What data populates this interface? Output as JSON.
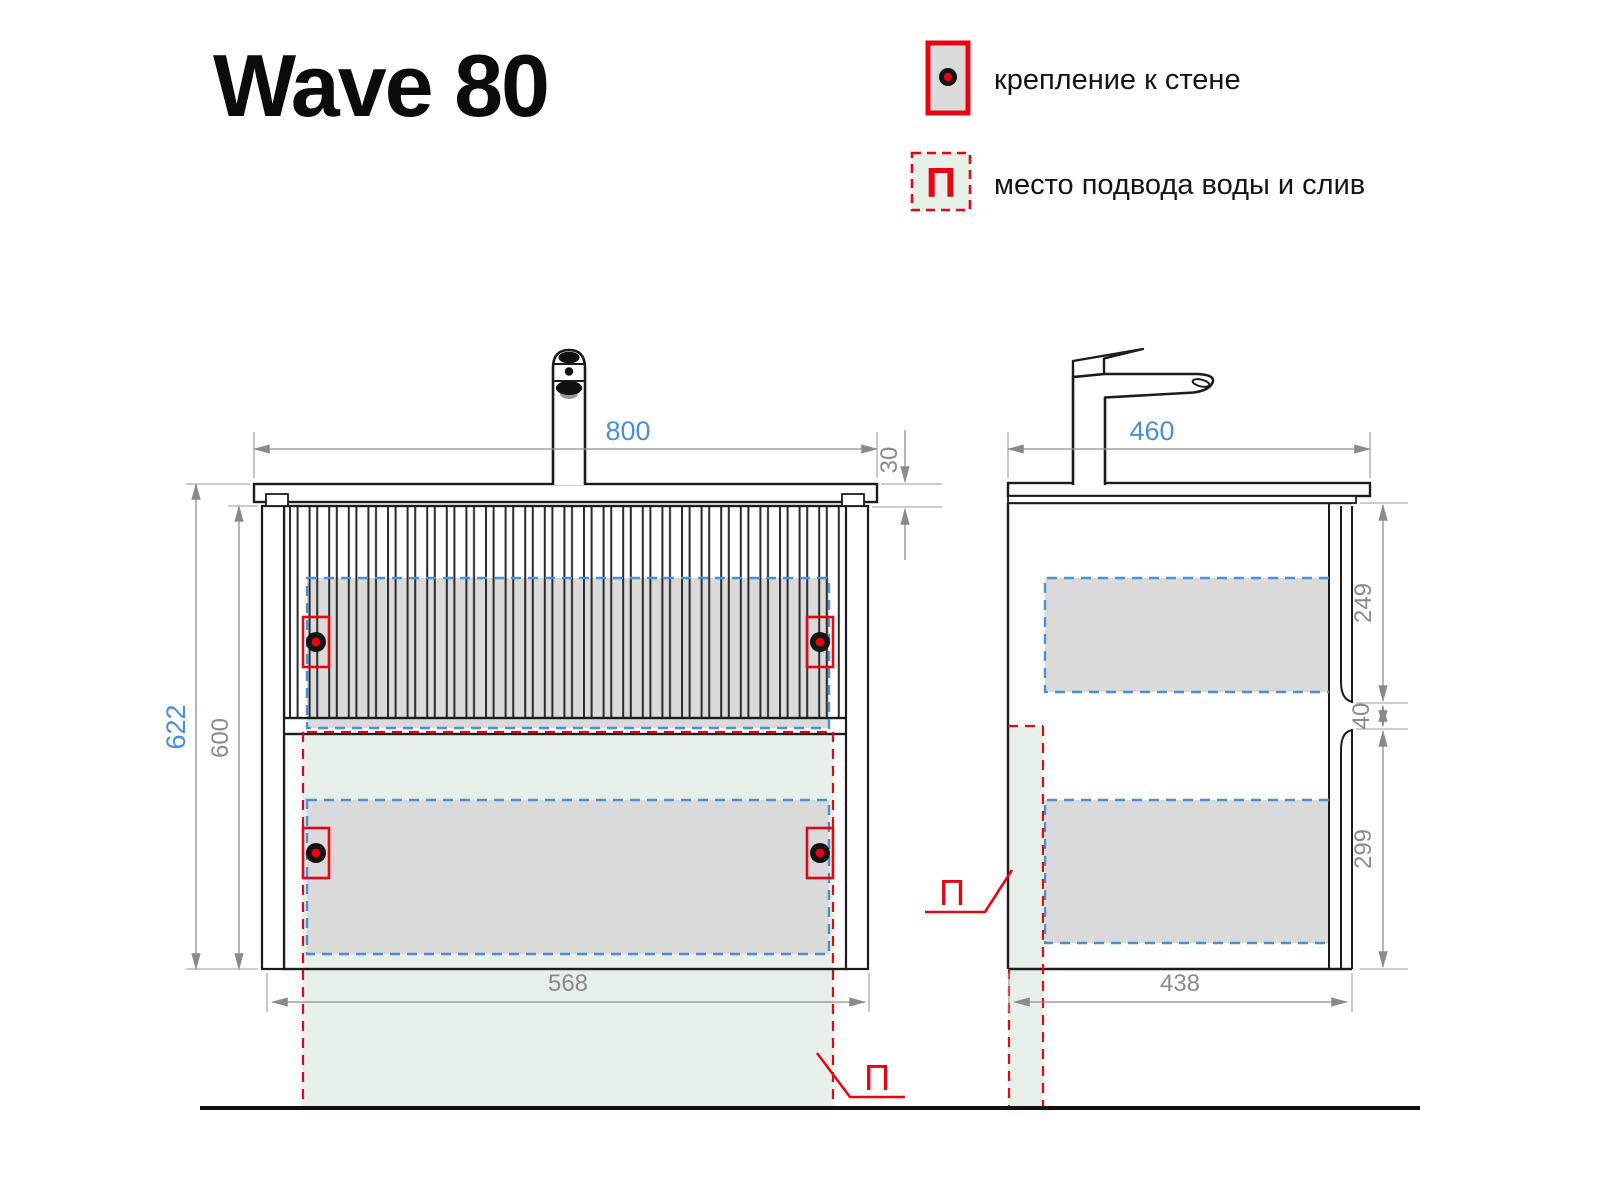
{
  "title": "Wave 80",
  "legend": {
    "items": [
      {
        "symbol": "wall-mount-marker",
        "label": "крепление к стене"
      },
      {
        "symbol": "П",
        "label": "место подвода воды и слив"
      }
    ]
  },
  "front_view": {
    "dims": {
      "width": "800",
      "countertop_thickness": "30",
      "overall_height": "622",
      "cabinet_height": "600",
      "mount_width": "568"
    },
    "zone_label": "П"
  },
  "side_view": {
    "dims": {
      "depth": "460",
      "upper_drawer": "249",
      "drawer_gap": "40",
      "lower_drawer": "299",
      "cabinet_depth": "438"
    },
    "zone_label": "П"
  },
  "colors": {
    "dimension_blue": "#4a90d2",
    "dimension_gray": "#8a8a8a",
    "marking_red": "#e30613",
    "zone_green_fill": "#e6f0e8",
    "panel_gray_fill": "#dadada",
    "line_black": "#1c1c1c"
  }
}
